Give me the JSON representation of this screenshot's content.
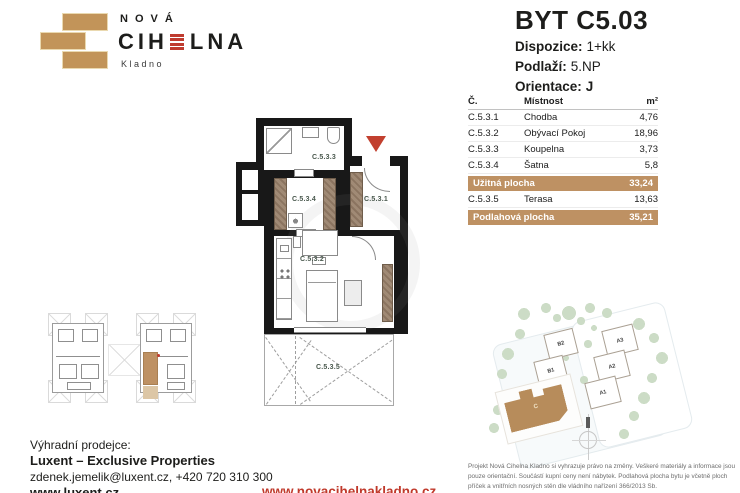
{
  "brand": {
    "name_top": "NOVÁ",
    "name_main_pre": "CIH",
    "name_main_post": "LNA",
    "city": "Kladno"
  },
  "unit": {
    "title": "BYT C5.03",
    "specs": [
      {
        "label": "Dispozice:",
        "value": "1+kk"
      },
      {
        "label": "Podlaží:",
        "value": "5.NP"
      },
      {
        "label": "Orientace:",
        "value": "J"
      }
    ]
  },
  "room_table": {
    "headers": {
      "no": "Č.",
      "room": "Místnost",
      "area": "m²"
    },
    "rows": [
      {
        "no": "C.5.3.1",
        "room": "Chodba",
        "area": "4,76"
      },
      {
        "no": "C.5.3.2",
        "room": "Obývací Pokoj",
        "area": "18,96"
      },
      {
        "no": "C.5.3.3",
        "room": "Koupelna",
        "area": "3,73"
      },
      {
        "no": "C.5.3.4",
        "room": "Šatna",
        "area": "5,8"
      }
    ],
    "usable_area": {
      "label": "Užitná plocha",
      "value": "33,24"
    },
    "terrace_row": {
      "no": "C.5.3.5",
      "room": "Terasa",
      "area": "13,63"
    },
    "floor_area": {
      "label": "Podlahová plocha",
      "value": "35,21"
    }
  },
  "floorplan": {
    "labels": {
      "hall": "C.5.3.1",
      "living": "C.5.3.2",
      "bath": "C.5.3.3",
      "closet": "C.5.3.4",
      "terrace": "C.5.3.5"
    }
  },
  "siteplan": {
    "buildings": [
      {
        "label": "B2"
      },
      {
        "label": "B1"
      },
      {
        "label": "A3"
      },
      {
        "label": "A2"
      },
      {
        "label": "A1"
      },
      {
        "label": "C"
      }
    ]
  },
  "footer": {
    "seller_heading": "Výhradní prodejce:",
    "seller_name": "Luxent – Exclusive Properties",
    "seller_contact": "zdenek.jemelik@luxent.cz, +420 720 310 300",
    "seller_web": "www.luxent.cz",
    "project_web": "www.novacihelnakladno.cz",
    "disclaimer": "Projekt Nová Cihelna Kladno si vyhrazuje právo na změny. Veškeré materiály a informace jsou pouze orientační. Součástí kupní ceny není nábytek. Podlahová plocha bytu je včetně ploch příček a vnitřních nosných stěn dle vládního nařízení 366/2013 Sb."
  },
  "colors": {
    "brick_accent": "#be9163",
    "red_accent": "#bf3b2f",
    "room_label_green": "#49584d"
  }
}
